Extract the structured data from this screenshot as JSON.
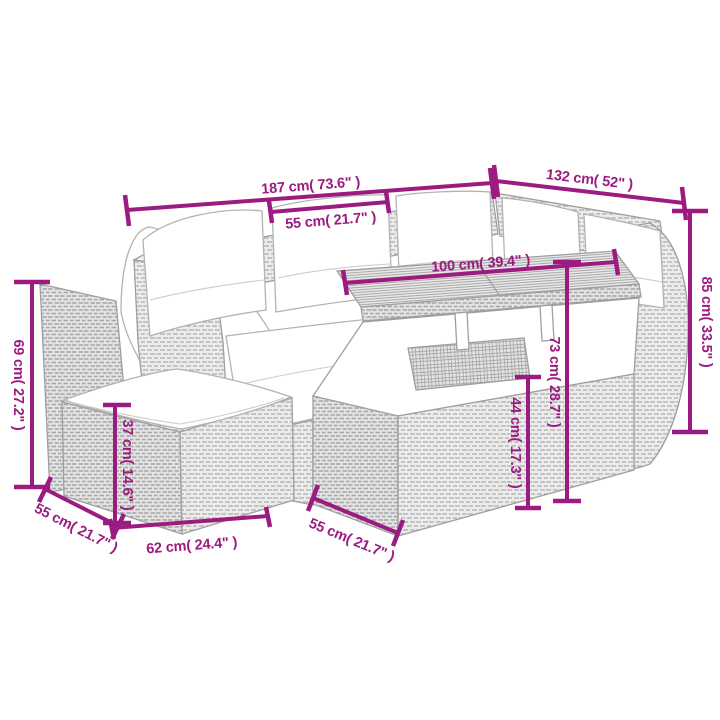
{
  "diagram": {
    "kind": "product-dimension-diagram",
    "subject": "rattan garden lounge set with corner sofa, table and ottoman"
  },
  "colors": {
    "dimension_line": "#9c1b80",
    "sketch_outline": "#9f9f9f",
    "cushion_fill": "#ffffff",
    "background": "#ffffff"
  },
  "dimensions": {
    "sofa_total_width": "187 cm( 73.6\" )",
    "right_sofa_width": "132 cm( 52\" )",
    "seat_cushion_width": "55 cm( 21.7\" )",
    "table_top_width": "100 cm( 39.4\" )",
    "overall_height": "85 cm( 33.5\" )",
    "left_backrest_height": "69 cm( 27.2\" )",
    "ottoman_height": "37 cm( 14.6\" )",
    "table_height": "73 cm( 28.7\" )",
    "table_clearance_height": "44 cm( 17.3\" )",
    "ottoman_depth": "55 cm( 21.7\" )",
    "ottoman_width": "62 cm( 24.4\" )",
    "table_depth": "55 cm( 21.7\" )"
  }
}
